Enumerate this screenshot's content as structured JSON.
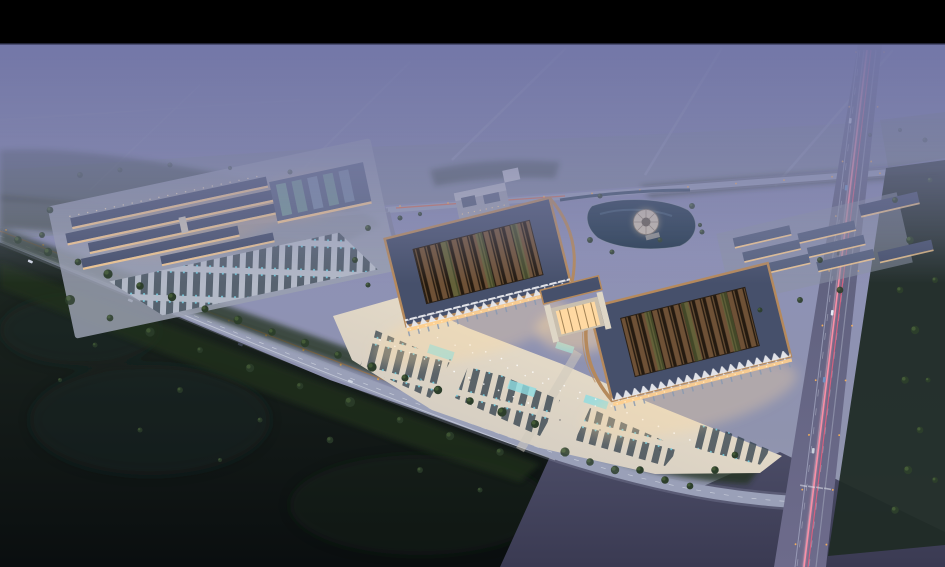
{
  "scene": {
    "description": "dusk-aerial-architectural-render",
    "letterbox_top_height_px": 44
  },
  "colors": {
    "letterbox": "#000000",
    "fog_top": "#7377a8",
    "fog_mid": "#8e91b6",
    "fog_low": "#97998e",
    "green_field": "#7c8a82",
    "canopy": "#24331f",
    "tree": "#2c3e2b",
    "tree_hi": "#49603a",
    "field_mid": "#1e2822",
    "field_dark": "#0a0e0f",
    "road": "#7e8298",
    "road_light": "#9aa0b8",
    "asphalt": "#4b4c66",
    "asphalt_low": "#3a3a52",
    "hw_top": "#585c77",
    "hw_bot": "#6d6b8b",
    "lane": "#b6bacb",
    "trail_pink": "#ff8fa6",
    "trail_red": "#e0607e",
    "trail_white": "#cfd4ec",
    "trail_orange": "#e8955a",
    "streetlight": "#ffb558",
    "pad": "#9aa0b0",
    "plaza_light": "#c9c4bf",
    "plaza_warm": "#efe3cd",
    "stall": "#33414d",
    "stall_tick": "#6fd3e8",
    "teal": "#8fdde2",
    "roof_slate": "#46506b",
    "roof_slate_hi": "#57627e",
    "copper": "#b5895c",
    "lattice_dark": "#241a10",
    "lattice_wood": "#6e5136",
    "roof_green": "#5d6f3d",
    "truss": "#e9eaee",
    "column": "#8a9ab0",
    "warm_light": "#ffcf8e",
    "glass_warm": "#ffd9a2",
    "wall_light": "#cac3b6",
    "water": "#23394d",
    "pavilion": "#cabfae"
  }
}
